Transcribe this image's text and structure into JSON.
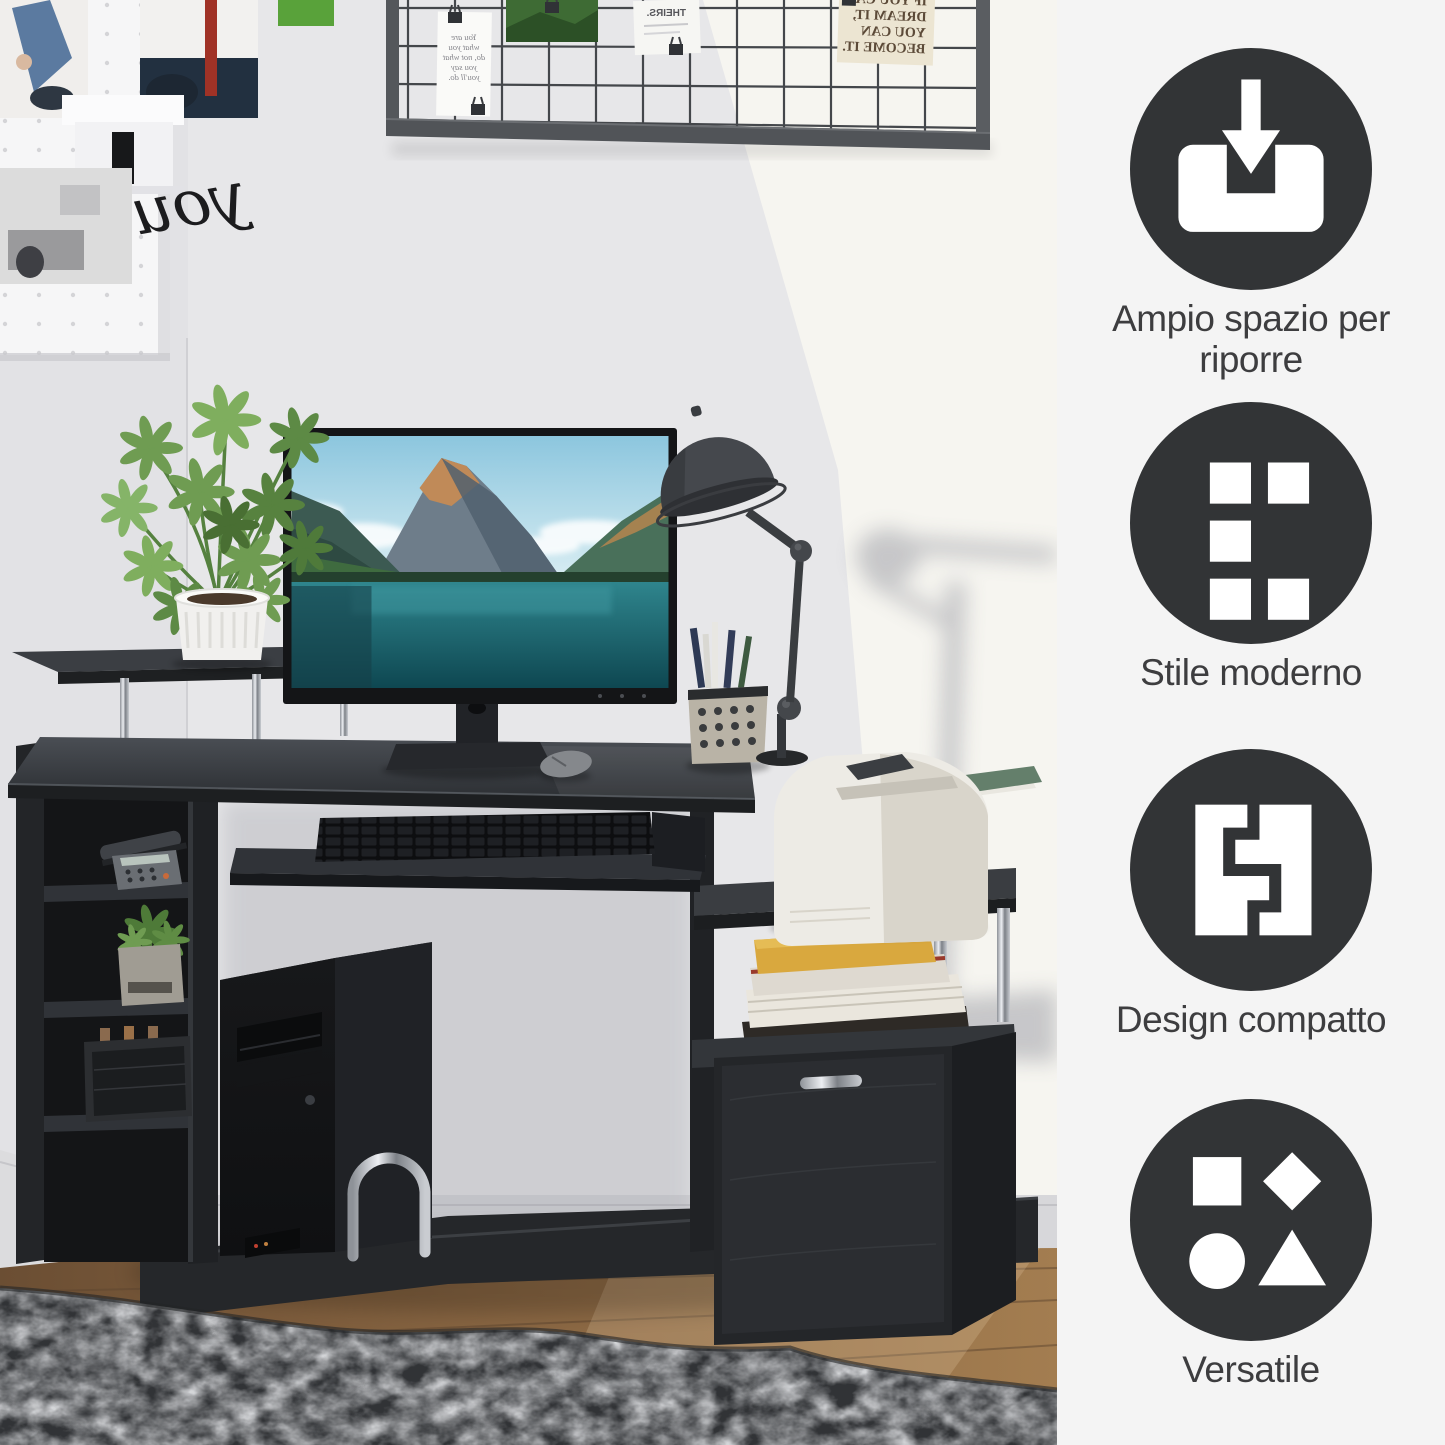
{
  "features": [
    {
      "id": "storage",
      "icon": "tray-arrow-down-icon",
      "label": "Ampio spazio per riporre"
    },
    {
      "id": "modern",
      "icon": "squares-grid-icon",
      "label": "Stile moderno"
    },
    {
      "id": "compact",
      "icon": "interlocking-blocks-icon",
      "label": "Design compatto"
    },
    {
      "id": "versatile",
      "icon": "geometric-shapes-icon",
      "label": "Versatile"
    }
  ],
  "panel": {
    "background": "#f4f4f4",
    "circle_color": "#323436",
    "label_color": "#3d3d3f"
  },
  "scene": {
    "pegboard_word": "you",
    "memo_note_lines": [
      "You are",
      "what you",
      "do, not what",
      "you say",
      "you'll do."
    ],
    "memo_note_label": "THEIRS.",
    "poster_lines": [
      "IF YOU CAN",
      "DREAM IT,",
      "YOU CAN",
      "BECOME IT."
    ],
    "colors": {
      "wall": "#e7e7e9",
      "sunlit_wall": "#f7f5f0",
      "desk_black": "#232528",
      "rug": "#313336",
      "wood_floor": "#8a6743",
      "printer_white": "#edebe5",
      "plant_green": "#6f9c52",
      "screen_lake_teal": "#2f858d"
    }
  }
}
